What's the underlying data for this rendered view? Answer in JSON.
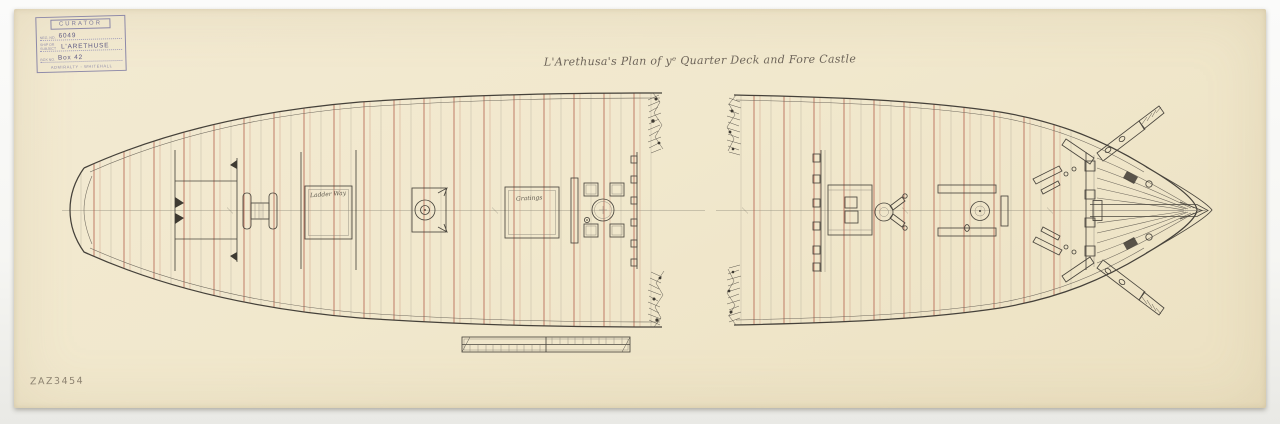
{
  "photo": {
    "catalogue_number": "ZAZ3454",
    "background_color": "#f6f6f4",
    "paper_color": "#f1e8cd"
  },
  "stamp": {
    "header": "CURATOR",
    "fields": [
      {
        "label": "Neg. No.",
        "value": "6049"
      },
      {
        "label": "Ship or Subject",
        "value": "L'ARETHUSE"
      },
      {
        "label": "Box No.",
        "value": "Box 42"
      }
    ],
    "footer": "ADMIRALTY - WHITEHALL"
  },
  "drawing": {
    "title": "L'Arethusa's Plan of yᵉ Quarter Deck and Fore Castle",
    "deck_labels": [
      {
        "id": "ladder-way",
        "text": "Ladder Way"
      },
      {
        "id": "gratings",
        "text": "Gratings"
      }
    ],
    "ink_color": "#4a463e",
    "beam_line_color": "#b3604c"
  }
}
